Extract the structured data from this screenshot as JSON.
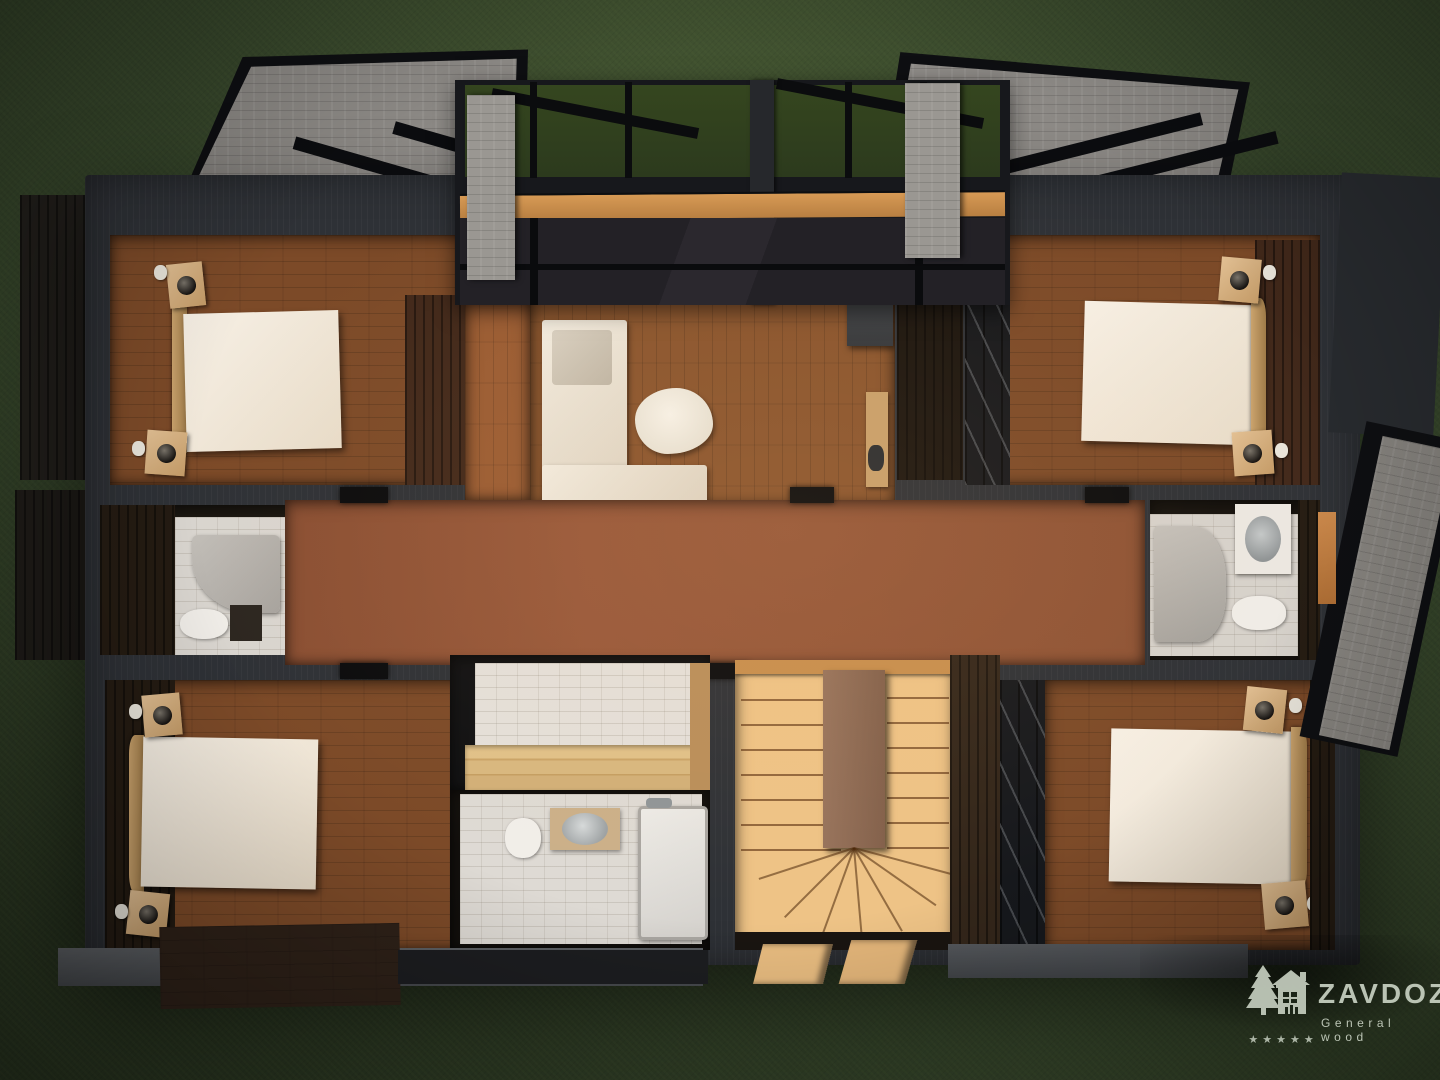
{
  "watermark": {
    "brand": "ZAVDOZ",
    "tagline": "General wood",
    "star_count": 5,
    "color": "#c8d1c2",
    "icon": "pine-tree-and-log-house"
  },
  "scene": {
    "description": "Top-down 3D render of the upper floor of a dark log house with four bedrooms, bathrooms, a sauna, a living area and a winder staircase, set on green grass.",
    "palette": {
      "grass": "#36462b",
      "grass_dark": "#293721",
      "wall": "#2e3136",
      "wall_dark": "#17181b",
      "floor_wood": "#7c4a28",
      "floor_wood_light": "#8a552e",
      "hall_parquet": "#92563a",
      "dark_plank": "#3b2517",
      "tile": "#d9d5cf",
      "stair_wood": "#eec386",
      "bench_wood": "#d8b87f",
      "beam_wood": "#c78e4d",
      "bed_linen": "#f3ebdf",
      "nightstand_wood": "#d7b285",
      "roof_gray": "#8e8b87",
      "stone_gray": "#9a9792",
      "wm": "#c8d1c2"
    },
    "rooms": [
      {
        "name": "bedroom-top-left",
        "furniture": [
          "double-bed",
          "nightstand",
          "nightstand",
          "table-lamp",
          "table-lamp"
        ]
      },
      {
        "name": "living-area",
        "furniture": [
          "corner-sofa",
          "fur-rug",
          "fireplace",
          "console-table"
        ]
      },
      {
        "name": "bedroom-top-right",
        "furniture": [
          "double-bed",
          "nightstand",
          "nightstand",
          "table-lamp",
          "table-lamp"
        ]
      },
      {
        "name": "bathroom-left",
        "furniture": [
          "shower",
          "toilet",
          "vanity"
        ]
      },
      {
        "name": "hallway",
        "furniture": []
      },
      {
        "name": "bathroom-right",
        "furniture": [
          "shower",
          "washbasin",
          "toilet"
        ]
      },
      {
        "name": "bedroom-bottom-left",
        "furniture": [
          "double-bed",
          "nightstand",
          "nightstand",
          "table-lamp",
          "table-lamp"
        ]
      },
      {
        "name": "sauna",
        "furniture": [
          "wooden-bench"
        ]
      },
      {
        "name": "bathroom-center",
        "furniture": [
          "toilet",
          "washbasin",
          "shower-tray"
        ]
      },
      {
        "name": "staircase",
        "furniture": [
          "winder-stairs",
          "newel-column"
        ]
      },
      {
        "name": "bedroom-bottom-right",
        "furniture": [
          "double-bed",
          "nightstand",
          "nightstand",
          "table-lamp",
          "table-lamp"
        ]
      }
    ]
  }
}
